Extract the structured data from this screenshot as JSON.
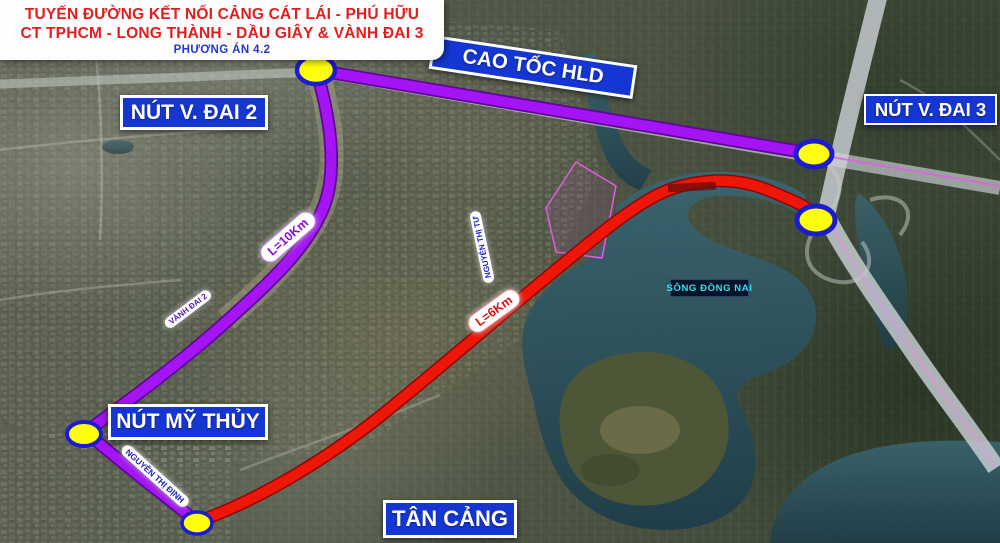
{
  "title": {
    "line1": "TUYẾN ĐƯỜNG KẾT NỐI CẢNG CÁT LÁI - PHÚ HỮU",
    "line2": "CT TPHCM - LONG THÀNH - DẦU GIÂY & VÀNH ĐAI 3",
    "line3": "PHƯƠNG ÁN 4.2"
  },
  "labels": {
    "cao_toc_hld": "CAO TỐC HLD",
    "nut_vanh_dai_2": "NÚT V. ĐAI 2",
    "nut_vanh_dai_3": "NÚT V. ĐAI 3",
    "nut_my_thuy": "NÚT MỸ THỦY",
    "tan_cang": "TÂN CẢNG",
    "song_dong_nai": "SÔNG ĐỒNG NAI"
  },
  "route_markers": {
    "purple_length": "L=10Km",
    "red_length": "L=6Km",
    "vanh_dai_2": "VÀNH ĐAI 2",
    "nguyen_thi_dinh": "NGUYỄN THỊ ĐỊNH",
    "nguyen_thi_tu": "NGUYỄN THỊ TƯ"
  },
  "colors": {
    "purple_route": "#a414f4",
    "purple_route_edge": "#5c0894",
    "red_route": "#ee1606",
    "red_route_edge": "#8e0505",
    "node_fill": "#ffff0a",
    "node_border": "#1b1bd0",
    "sign_blue": "#1536d2",
    "title_red": "#e21d1d",
    "plan_blue": "#2038cc",
    "river_text": "#3ae0ee"
  }
}
